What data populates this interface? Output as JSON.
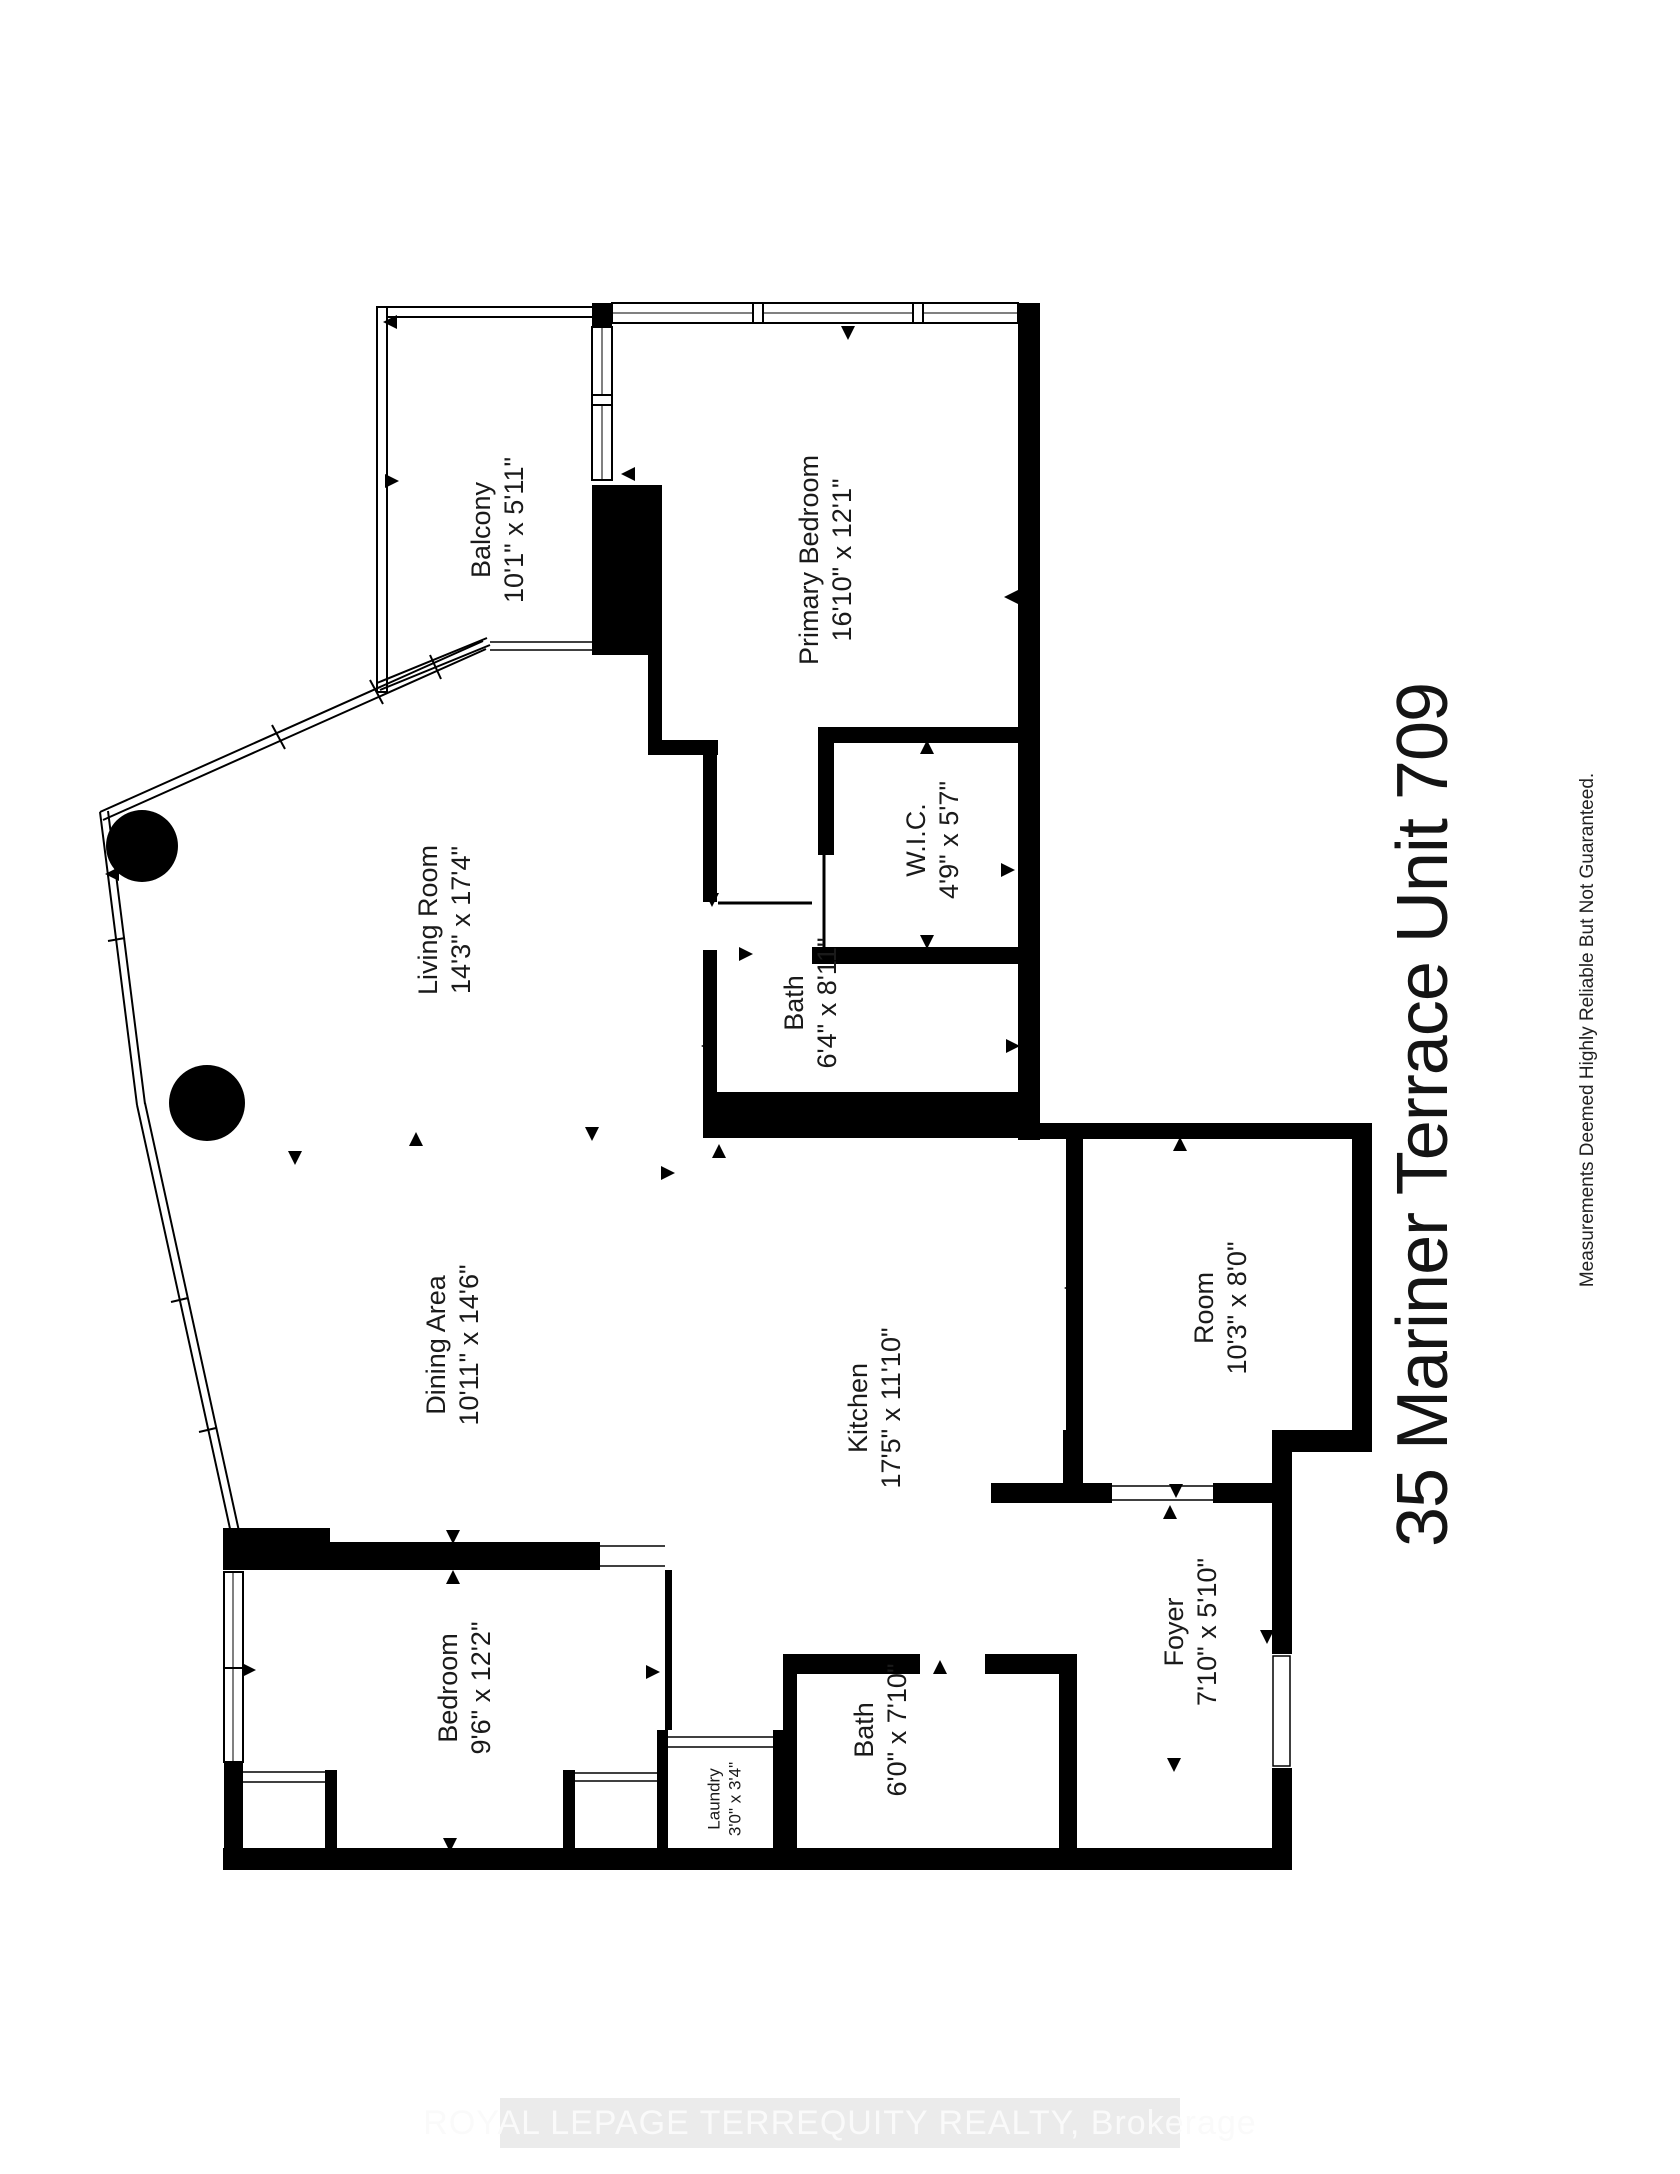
{
  "floorplan": {
    "title": "35 Mariner Terrace Unit 709",
    "disclaimer": "Measurements Deemed Highly Reliable But Not Guaranteed.",
    "watermark": "ROYAL LEPAGE TERREQUITY REALTY, Brokerage",
    "rooms": [
      {
        "id": "balcony",
        "name": "Balcony",
        "dimensions": "10'1\" x 5'11\"",
        "cx": 505,
        "cy": 530,
        "font_size": 27
      },
      {
        "id": "primary-bedroom",
        "name": "Primary Bedroom",
        "dimensions": "16'10\" x 12'1\"",
        "cx": 833,
        "cy": 560,
        "font_size": 27
      },
      {
        "id": "living-room",
        "name": "Living Room",
        "dimensions": "14'3\" x 17'4\"",
        "cx": 452,
        "cy": 920,
        "font_size": 27
      },
      {
        "id": "wic",
        "name": "W.I.C.",
        "dimensions": "4'9\" x 5'7\"",
        "cx": 940,
        "cy": 840,
        "font_size": 27
      },
      {
        "id": "bath-upper",
        "name": "Bath",
        "dimensions": "6'4\" x 8'11\"",
        "cx": 818,
        "cy": 1003,
        "font_size": 27
      },
      {
        "id": "dining-area",
        "name": "Dining Area",
        "dimensions": "10'11\" x 14'6\"",
        "cx": 460,
        "cy": 1345,
        "font_size": 27
      },
      {
        "id": "kitchen",
        "name": "Kitchen",
        "dimensions": "17'5\" x 11'10\"",
        "cx": 882,
        "cy": 1408,
        "font_size": 27
      },
      {
        "id": "room",
        "name": "Room",
        "dimensions": "10'3\" x 8'0\"",
        "cx": 1228,
        "cy": 1308,
        "font_size": 27
      },
      {
        "id": "foyer",
        "name": "Foyer",
        "dimensions": "7'10\" x 5'10\"",
        "cx": 1198,
        "cy": 1632,
        "font_size": 27
      },
      {
        "id": "bedroom",
        "name": "Bedroom",
        "dimensions": "9'6\" x 12'2\"",
        "cx": 472,
        "cy": 1688,
        "font_size": 27
      },
      {
        "id": "bath-lower",
        "name": "Bath",
        "dimensions": "6'0\" x 7'10\"",
        "cx": 888,
        "cy": 1730,
        "font_size": 27
      },
      {
        "id": "laundry",
        "name": "Laundry",
        "dimensions": "3'0\" x 3'4\"",
        "cx": 729,
        "cy": 1799,
        "font_size": 17
      }
    ]
  }
}
